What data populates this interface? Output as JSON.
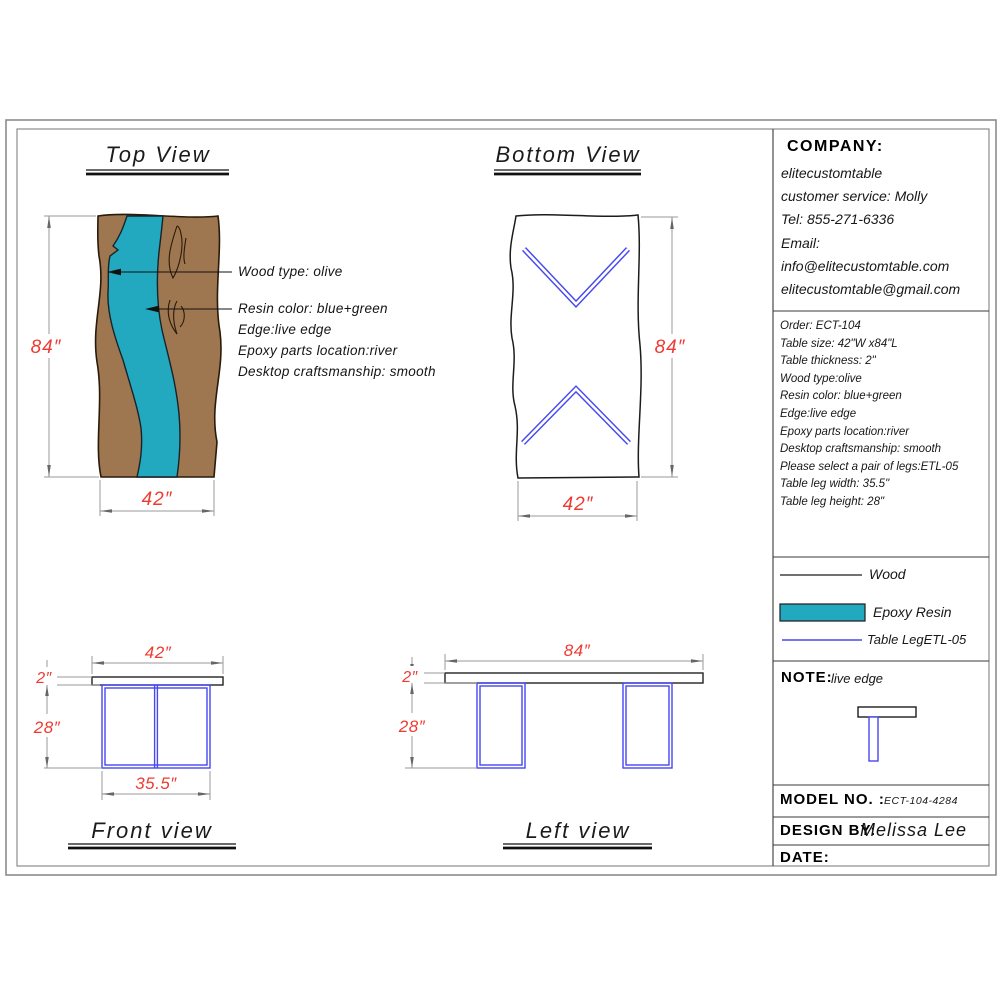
{
  "colors": {
    "wood": "#9e7750",
    "wood_edge": "#2a1a0a",
    "resin": "#23a9bf",
    "leg": "#4848f0",
    "dim_text": "#ee3b32",
    "line": "#1c1c1c"
  },
  "views": {
    "top": {
      "title": "Top View",
      "dim_height": "84″",
      "dim_width": "42″",
      "labels": {
        "wood": "Wood type: olive",
        "resin": "Resin color: blue+green",
        "edge": "Edge:live edge",
        "epoxy": "Epoxy parts location:river",
        "craftsmanship": "Desktop craftsmanship: smooth"
      }
    },
    "bottom": {
      "title": "Bottom View",
      "dim_height": "84″",
      "dim_width": "42″"
    },
    "front": {
      "title": "Front view",
      "dim_top_width": "42″",
      "dim_thickness": "2″",
      "dim_leg_height": "28″",
      "dim_leg_width": "35.5″"
    },
    "left": {
      "title": "Left view",
      "dim_top_width": "84″",
      "dim_thickness": "2″",
      "dim_leg_height": "28″"
    }
  },
  "panel": {
    "company": {
      "heading": "COMPANY:",
      "lines": [
        "elitecustomtable",
        "customer service: Molly",
        "Tel: 855-271-6336",
        "Email:",
        "info@elitecustomtable.com",
        "elitecustomtable@gmail.com"
      ]
    },
    "order": {
      "lines": [
        "Order: ECT-104",
        "Table size: 42\"W x84\"L",
        "Table thickness: 2\"",
        "Wood type:olive",
        "Resin color: blue+green",
        "Edge:live edge",
        "Epoxy parts location:river",
        "Desktop craftsmanship: smooth",
        "Please select a pair of legs:ETL-05",
        "Table leg width: 35.5\"",
        "Table leg height: 28\""
      ]
    },
    "legend": {
      "wood_label": "Wood",
      "resin_label": "Epoxy Resin",
      "leg_label": "Table LegETL-05"
    },
    "note": {
      "heading": "NOTE:",
      "text": "live edge"
    },
    "model": {
      "label": "MODEL NO. :",
      "value": "ECT-104-4284"
    },
    "design": {
      "label": "DESIGN BY:",
      "value": "Melissa Lee"
    },
    "date": {
      "label": "DATE:"
    }
  }
}
